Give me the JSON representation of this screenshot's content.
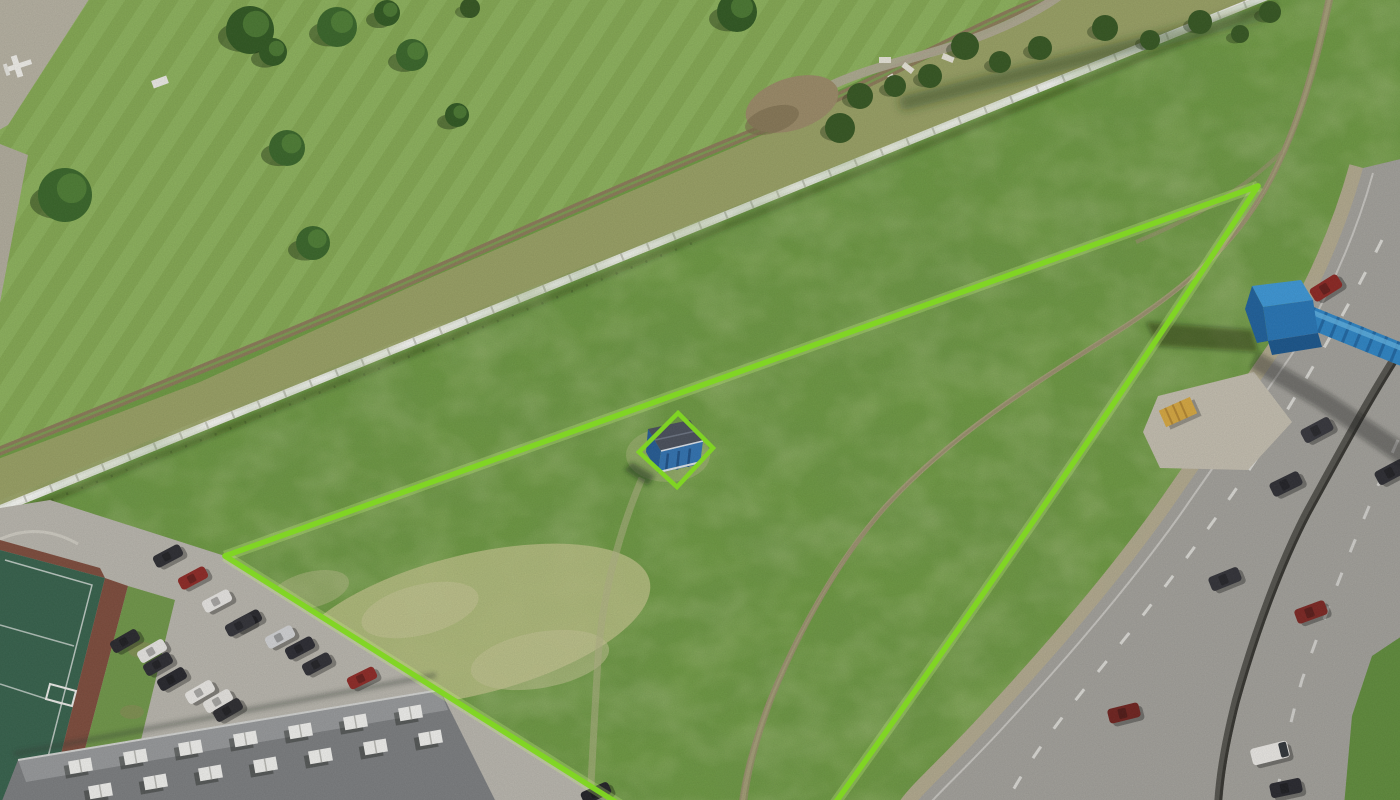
{
  "meta": {
    "kind": "drone-aerial-photograph",
    "subject": "Vacant grassland plot for sale outlined with a bright green boundary; small blue shed inside its own green diamond; white panel fence and mowed park with trees above; curving multi-lane road with blue pedestrian overpass on the right; parking lot, tennis court and flat-roof building at bottom left",
    "width": 1400,
    "height": 800
  },
  "colors": {
    "grass_base": "#6d9a40",
    "park_a": "#84a951",
    "park_b": "#8db35b",
    "band": "#99a163",
    "dirt_road": "#8b7a57",
    "path_gray": "#b0a895",
    "fence": "#f5f5f1",
    "road": "#a3a19b",
    "shoulder": "#b6ab92",
    "median": "#53524c",
    "lot": "#bab7ae",
    "sidewalk": "#c5bfb0",
    "roof": "#7b7d7f",
    "roof_light": "#97999b",
    "court": "#34604a",
    "court_red": "#7d4a3a",
    "court_grass": "#6f9747",
    "boundary": "#80d622",
    "boundary_glow": "#c9f381",
    "bridge": "#2e8bd0",
    "bridge_front": "#2474b6",
    "bridge_side": "#1c5f9c",
    "bridge_tube": "#2b84c6",
    "bridge_tube_rib": "#1d66a4",
    "shed_roof": "#484e5a",
    "shed_wall": "#2f72b2",
    "dry_patch": "#bac083",
    "sliver": "#5f8c3a",
    "dumpster": "#d8a83e",
    "trail": "#a89d7a",
    "gravel": "#b7b2a2",
    "tree_dark": "#2e571f",
    "tree_mid": "#376527"
  },
  "boundary": {
    "stroke": "#80d622",
    "vertex_right": [
      1258,
      186
    ],
    "vertex_left": [
      225,
      556
    ],
    "bottom_exit_left": [
      622,
      806
    ],
    "bottom_exit_right": [
      833,
      806
    ],
    "curve_control": [
      1060,
      490
    ],
    "diamond": [
      [
        678,
        413
      ],
      [
        713,
        448
      ],
      [
        677,
        487
      ],
      [
        639,
        452
      ]
    ]
  },
  "trees": [
    {
      "x": 65,
      "y": 195,
      "r": 27
    },
    {
      "x": 250,
      "y": 30,
      "r": 24
    },
    {
      "x": 287,
      "y": 148,
      "r": 18
    },
    {
      "x": 273,
      "y": 52,
      "r": 14
    },
    {
      "x": 337,
      "y": 27,
      "r": 20
    },
    {
      "x": 387,
      "y": 13,
      "r": 13
    },
    {
      "x": 412,
      "y": 55,
      "r": 16
    },
    {
      "x": 457,
      "y": 115,
      "r": 12
    },
    {
      "x": 313,
      "y": 243,
      "r": 17
    },
    {
      "x": 737,
      "y": 12,
      "r": 20
    }
  ],
  "bushes": [
    {
      "x": 860,
      "y": 96,
      "r": 13
    },
    {
      "x": 895,
      "y": 86,
      "r": 11
    },
    {
      "x": 930,
      "y": 76,
      "r": 12
    },
    {
      "x": 965,
      "y": 46,
      "r": 14
    },
    {
      "x": 1000,
      "y": 62,
      "r": 11
    },
    {
      "x": 1040,
      "y": 48,
      "r": 12
    },
    {
      "x": 1105,
      "y": 28,
      "r": 13
    },
    {
      "x": 1150,
      "y": 40,
      "r": 10
    },
    {
      "x": 1200,
      "y": 22,
      "r": 12
    },
    {
      "x": 1240,
      "y": 34,
      "r": 9
    },
    {
      "x": 1270,
      "y": 12,
      "r": 11
    },
    {
      "x": 840,
      "y": 128,
      "r": 15
    },
    {
      "x": 470,
      "y": 8,
      "r": 10
    }
  ],
  "rubble": [
    [
      885,
      60
    ],
    [
      908,
      68
    ],
    [
      928,
      76
    ],
    [
      948,
      58
    ],
    [
      893,
      80
    ]
  ],
  "parking_cars": [
    [
      168,
      556,
      -28,
      "#2b2b30"
    ],
    [
      193,
      578,
      -28,
      "#8e2723"
    ],
    [
      217,
      601,
      -28,
      "#e9e7e4"
    ],
    [
      247,
      621,
      -28,
      "#26262b"
    ],
    [
      240,
      625,
      -28,
      "#303036"
    ],
    [
      280,
      637,
      -28,
      "#d3d4d6"
    ],
    [
      300,
      648,
      -28,
      "#292930"
    ],
    [
      317,
      664,
      -28,
      "#2d2d33"
    ],
    [
      362,
      678,
      -26,
      "#8e2723"
    ],
    [
      125,
      641,
      -30,
      "#26262b"
    ],
    [
      152,
      651,
      -30,
      "#e9e7e4"
    ],
    [
      158,
      664,
      -30,
      "#2a2a30"
    ],
    [
      172,
      679,
      -30,
      "#24242a"
    ],
    [
      200,
      692,
      -30,
      "#eceae6"
    ],
    [
      218,
      701,
      -30,
      "#e8e6e2"
    ],
    [
      228,
      710,
      -30,
      "#2a2a2e"
    ],
    [
      596,
      793,
      -24,
      "#1f1f24"
    ]
  ],
  "road_cars": [
    [
      1326,
      288,
      -32,
      "#8c2420",
      ""
    ],
    [
      1317,
      430,
      -28,
      "#34343a",
      ""
    ],
    [
      1286,
      484,
      -26,
      "#2c2c32",
      ""
    ],
    [
      1391,
      472,
      -28,
      "#2a2a30",
      ""
    ],
    [
      1225,
      579,
      -22,
      "#303036",
      ""
    ],
    [
      1311,
      612,
      -20,
      "#7c2420",
      ""
    ],
    [
      1124,
      713,
      -14,
      "#6f201c",
      ""
    ],
    [
      1270,
      753,
      -14,
      "#eceae6",
      "truck"
    ],
    [
      1286,
      788,
      -12,
      "#26262c",
      ""
    ]
  ],
  "rooftop_units": [
    [
      80,
      766
    ],
    [
      135,
      757
    ],
    [
      190,
      748
    ],
    [
      245,
      739
    ],
    [
      300,
      731
    ],
    [
      355,
      722
    ],
    [
      410,
      713
    ],
    [
      100,
      791
    ],
    [
      155,
      782
    ],
    [
      210,
      773
    ],
    [
      265,
      765
    ],
    [
      320,
      756
    ],
    [
      375,
      747
    ],
    [
      430,
      738
    ]
  ]
}
